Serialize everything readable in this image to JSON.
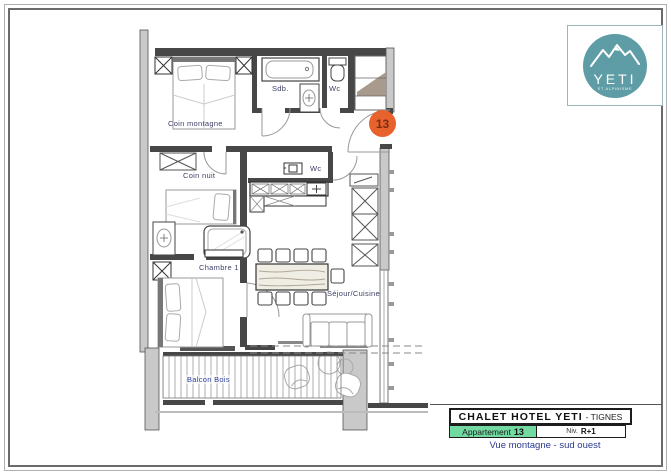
{
  "logo": {
    "name": "YETI",
    "subtext": "ET ALPINISME",
    "circle_color": "#5e9da6"
  },
  "badge": {
    "number": "13",
    "bg_color": "#e8622d",
    "text_color": "#7b2d10"
  },
  "plan": {
    "label_color": "#3d3f66",
    "labels": {
      "coin_montagne": "Coin montagne",
      "sdb": "Sdb.",
      "wc_top": "Wc",
      "coin_nuit": "Coin nuit",
      "wc_mid": "Wc",
      "chambre1": "Chambre 1",
      "sejour_cuisine": "Séjour/Cuisine",
      "balcon_bois": "Balcon Bois"
    }
  },
  "title_block": {
    "hotel_name": "CHALET HOTEL YETI",
    "location_suffix": "- TIGNES",
    "apartment_label": "Appartement",
    "apartment_number": "13",
    "level_label": "Niv.",
    "level_value": "R+1",
    "view_caption": "Vue montagne - sud ouest",
    "apartment_cell_color": "#72d9a1",
    "caption_color": "#2b3a8f"
  }
}
